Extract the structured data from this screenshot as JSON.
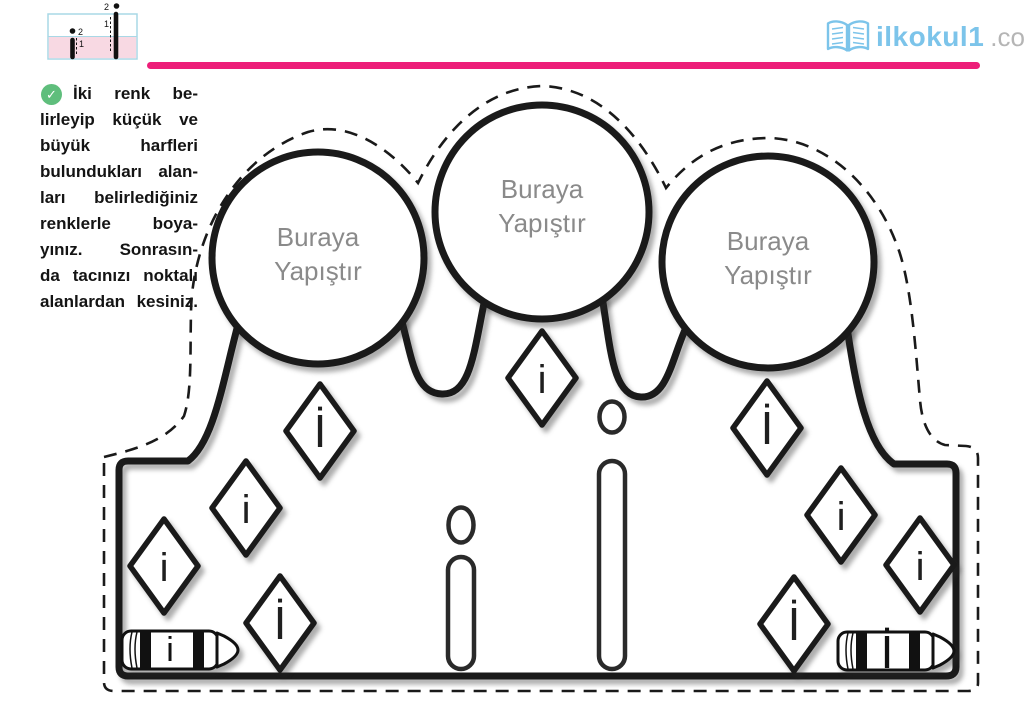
{
  "header": {
    "writing_guide": {
      "lowercase": {
        "letter": "i",
        "dot_step": "2",
        "stroke_step": "1"
      },
      "uppercase": {
        "letter": "İ",
        "dot_step": "2",
        "stroke_step": "1"
      }
    },
    "logo": {
      "text": "ilkokul1",
      "suffix": ".com"
    }
  },
  "instructions": {
    "check_icon": "✓",
    "lines": [
      "İki renk be-",
      "lirleyip küçük ve",
      "büyük harfleri",
      "bulundukları alan-",
      "ları belirlediğiniz",
      "renklerle boya-",
      "yınız. Sonrasın-",
      "da tacınızı noktalı",
      "alanlardan kesiniz."
    ],
    "full_text": "İki renk belirleyip küçük ve büyük harfleri bulundukları alanları belirlediğiniz renklerle boyayınız. Sonrasında tacınızı noktalı alanlardan kesiniz."
  },
  "crown": {
    "circles": [
      {
        "line1": "Buraya",
        "line2": "Yapıştır"
      },
      {
        "line1": "Buraya",
        "line2": "Yapıştır"
      },
      {
        "line1": "Buraya",
        "line2": "Yapıştır"
      }
    ],
    "diamond_letters": [
      "i",
      "İ",
      "i",
      "i",
      "İ",
      "İ",
      "i",
      "i",
      "İ"
    ],
    "trace_letters": {
      "small": "i",
      "capital": "İ"
    },
    "crayons": {
      "left_letter": "i",
      "right_letter": "İ"
    }
  },
  "colors": {
    "accent_pink": "#ed1e79",
    "logo_blue": "#7cc4ea",
    "logo_gray": "#b5b5b5",
    "check_green": "#5fbe7c",
    "circle_text_gray": "#8a8a8a",
    "guide_row_pink": "#f8d9e3",
    "guide_border_blue": "#a8d8e6",
    "ink": "#1a1a1a"
  }
}
